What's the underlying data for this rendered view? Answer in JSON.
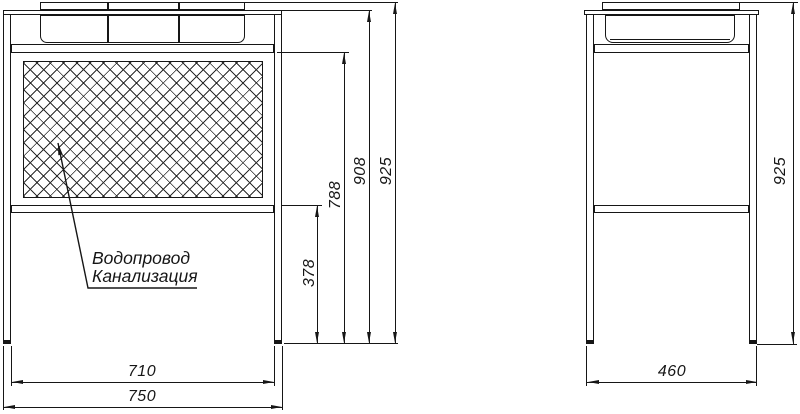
{
  "annotation": {
    "line1": "Водопровод",
    "line2": "Канализация"
  },
  "front_view": {
    "dims": {
      "h378": "378",
      "h788": "788",
      "h908": "908",
      "h925": "925",
      "w710": "710",
      "w750": "750"
    }
  },
  "side_view": {
    "dims": {
      "h925": "925",
      "d460": "460"
    }
  },
  "colors": {
    "line": "#161616",
    "background": "#ffffff"
  }
}
